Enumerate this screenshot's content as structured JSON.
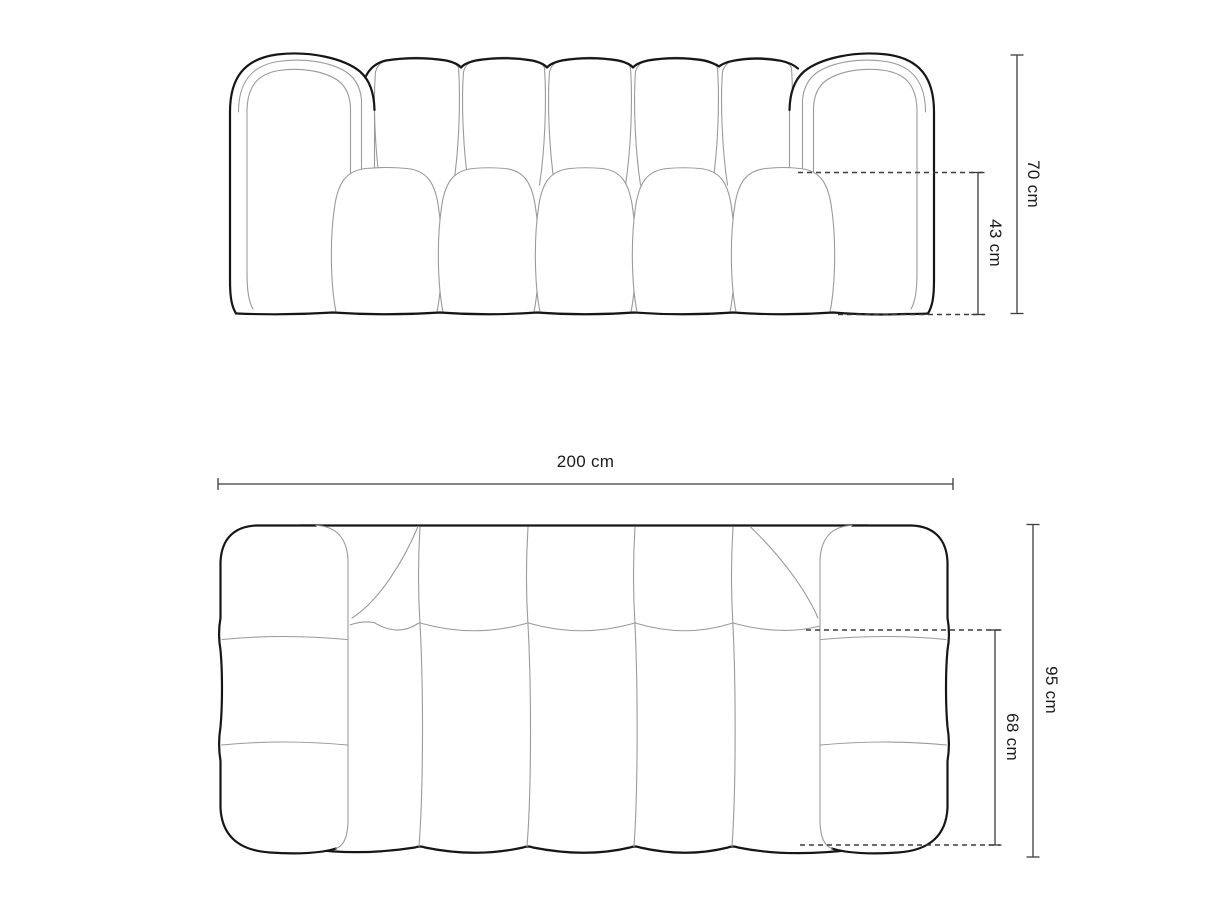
{
  "diagram": {
    "kind": "sofa-dimension-drawing",
    "views": {
      "front": {
        "dimensions": {
          "total_height": "70 cm",
          "seat_height": "43 cm"
        }
      },
      "top": {
        "dimensions": {
          "total_width": "200 cm",
          "total_depth": "95 cm",
          "seat_depth": "68 cm"
        }
      }
    }
  },
  "colors": {
    "bg": "#ffffff",
    "outline": "#161616",
    "seam": "#9a9a9a",
    "dim": "#3c3c3c",
    "label": "#1a1a1a"
  }
}
